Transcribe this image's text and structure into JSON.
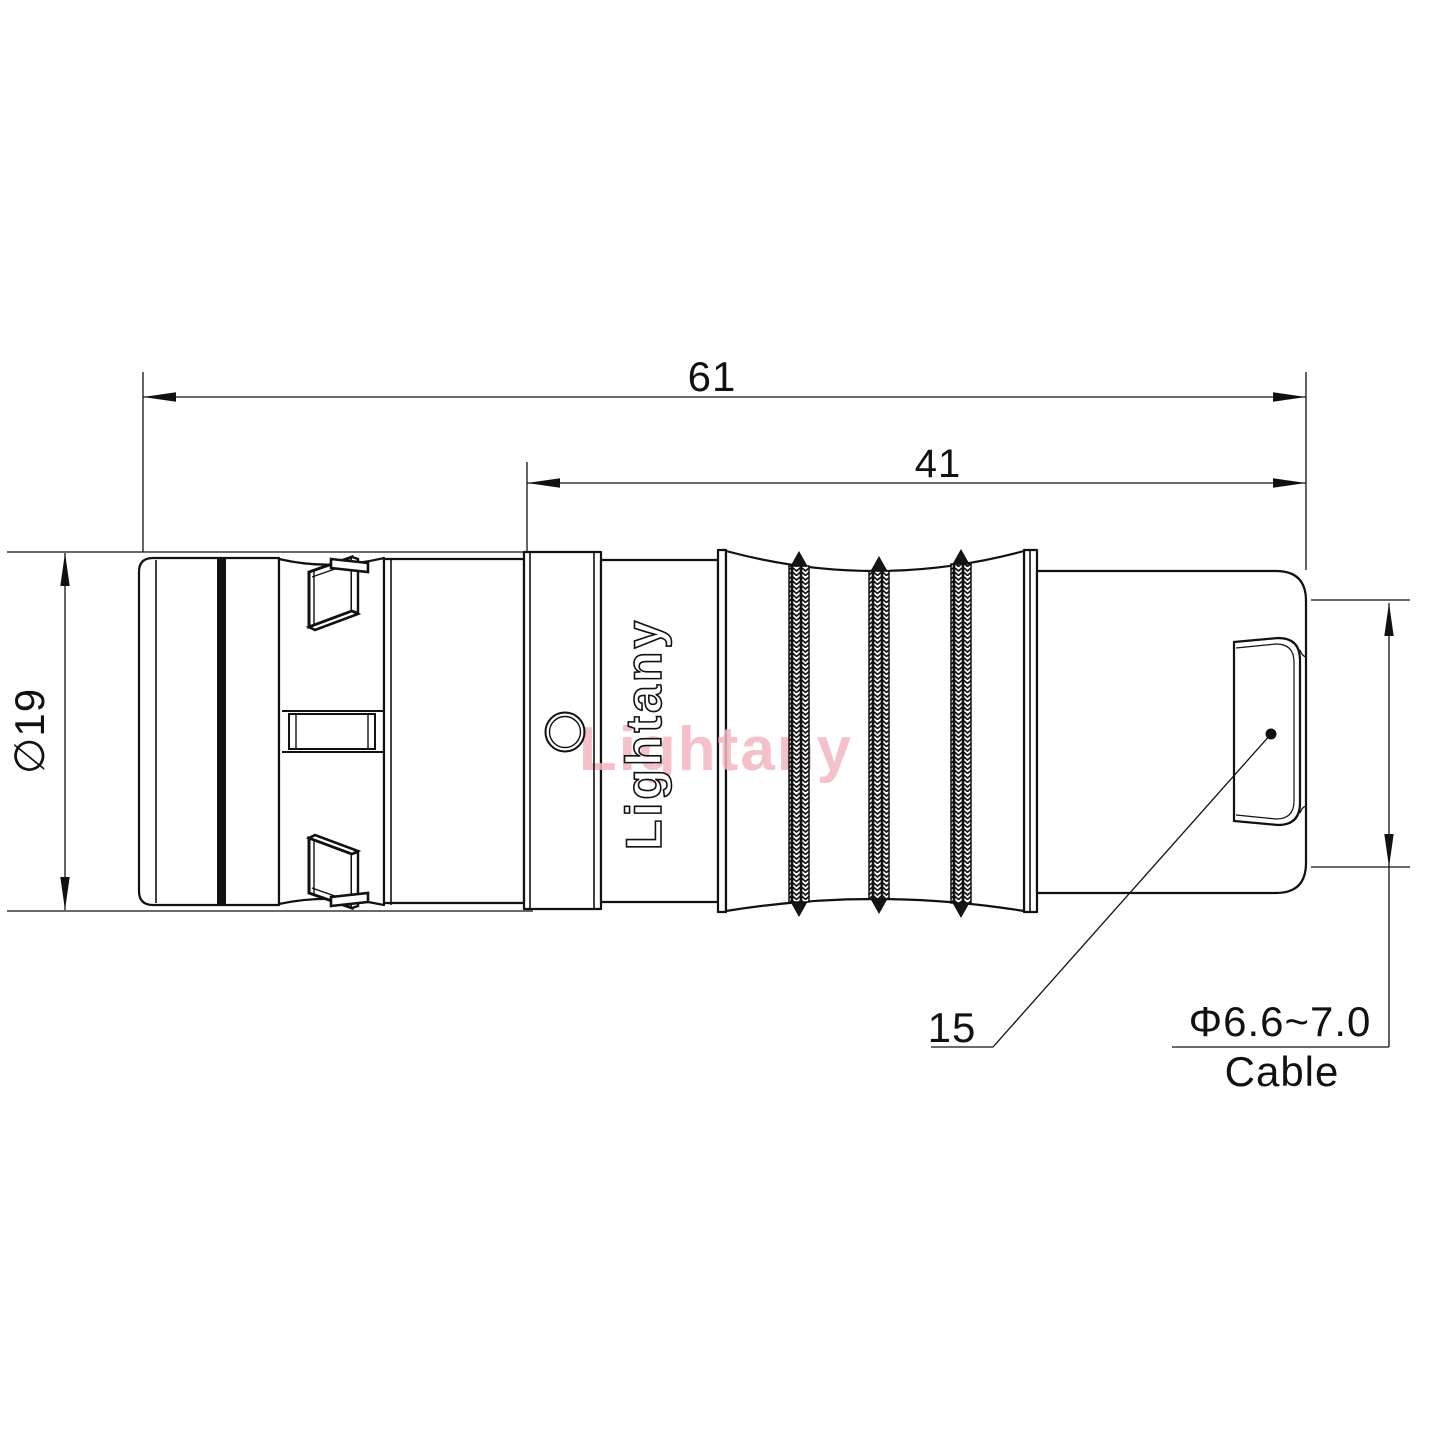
{
  "drawing": {
    "kind": "connector-dimension-drawing",
    "view": "side view of push-pull circular connector with cable boot",
    "dimensions": {
      "overall_length": "61",
      "rear_length": "41",
      "body_diameter": "∅19",
      "boot_callout": "15",
      "cable_range": "Φ6.6~7.0",
      "cable_label": "Cable"
    },
    "watermark": {
      "brand": "Lightany",
      "pink_color": "#f3b7c0"
    },
    "colors": {
      "line": "#111111",
      "background": "#ffffff",
      "knurl_fill": "#151515"
    }
  }
}
